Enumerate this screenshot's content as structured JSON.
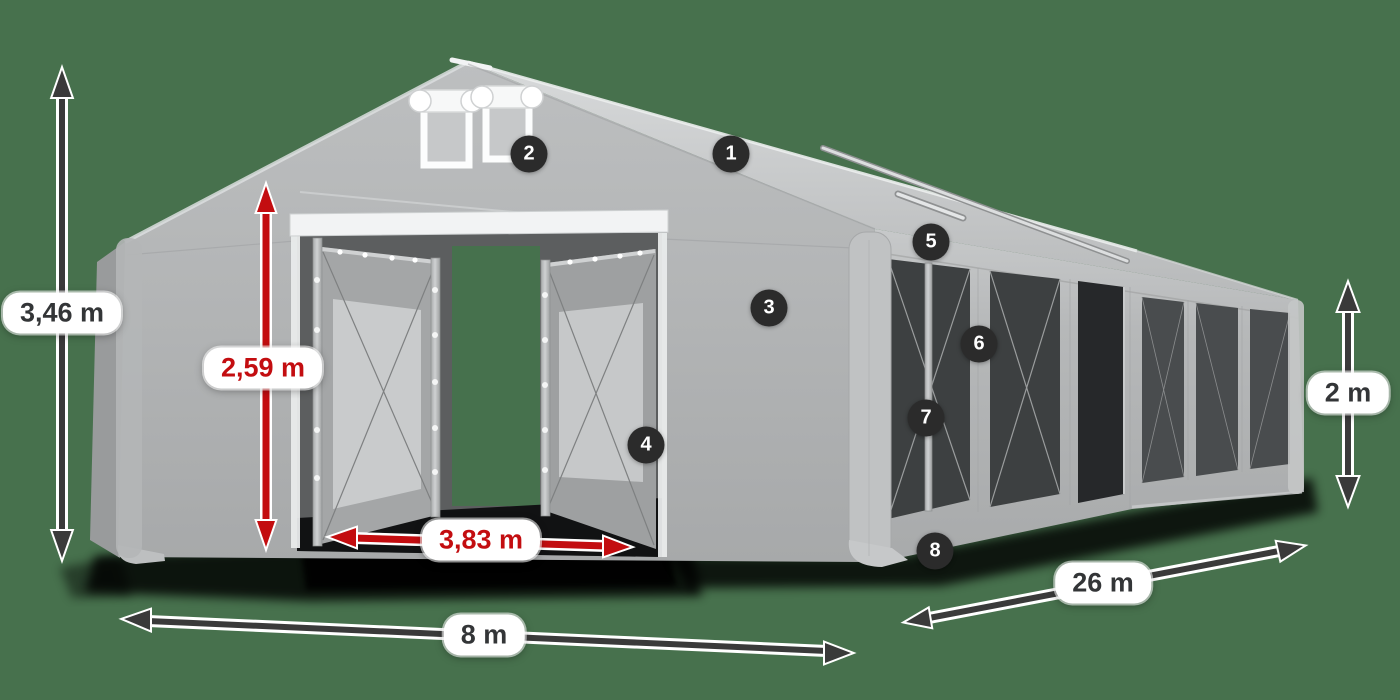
{
  "illustration": {
    "name": "marquee-tent-3d-annotated",
    "background_color": "#47714D",
    "tent_fabric_color": "#B4B6B7",
    "accent_red": "#C30D10",
    "arrow_dark": "#3A3A3A",
    "badge_color": "#2B2B2B",
    "label_pill_color": "#FFFFFF"
  },
  "dimensions": [
    {
      "id": "total-height",
      "label": "3,46 m",
      "style": "dark"
    },
    {
      "id": "entrance-height",
      "label": "2,59 m",
      "style": "red"
    },
    {
      "id": "entrance-width",
      "label": "3,83 m",
      "style": "red"
    },
    {
      "id": "gable-width",
      "label": "8 m",
      "style": "dark"
    },
    {
      "id": "length",
      "label": "26 m",
      "style": "dark"
    },
    {
      "id": "side-height",
      "label": "2 m",
      "style": "dark"
    }
  ],
  "markers": [
    "1",
    "2",
    "3",
    "4",
    "5",
    "6",
    "7",
    "8"
  ]
}
